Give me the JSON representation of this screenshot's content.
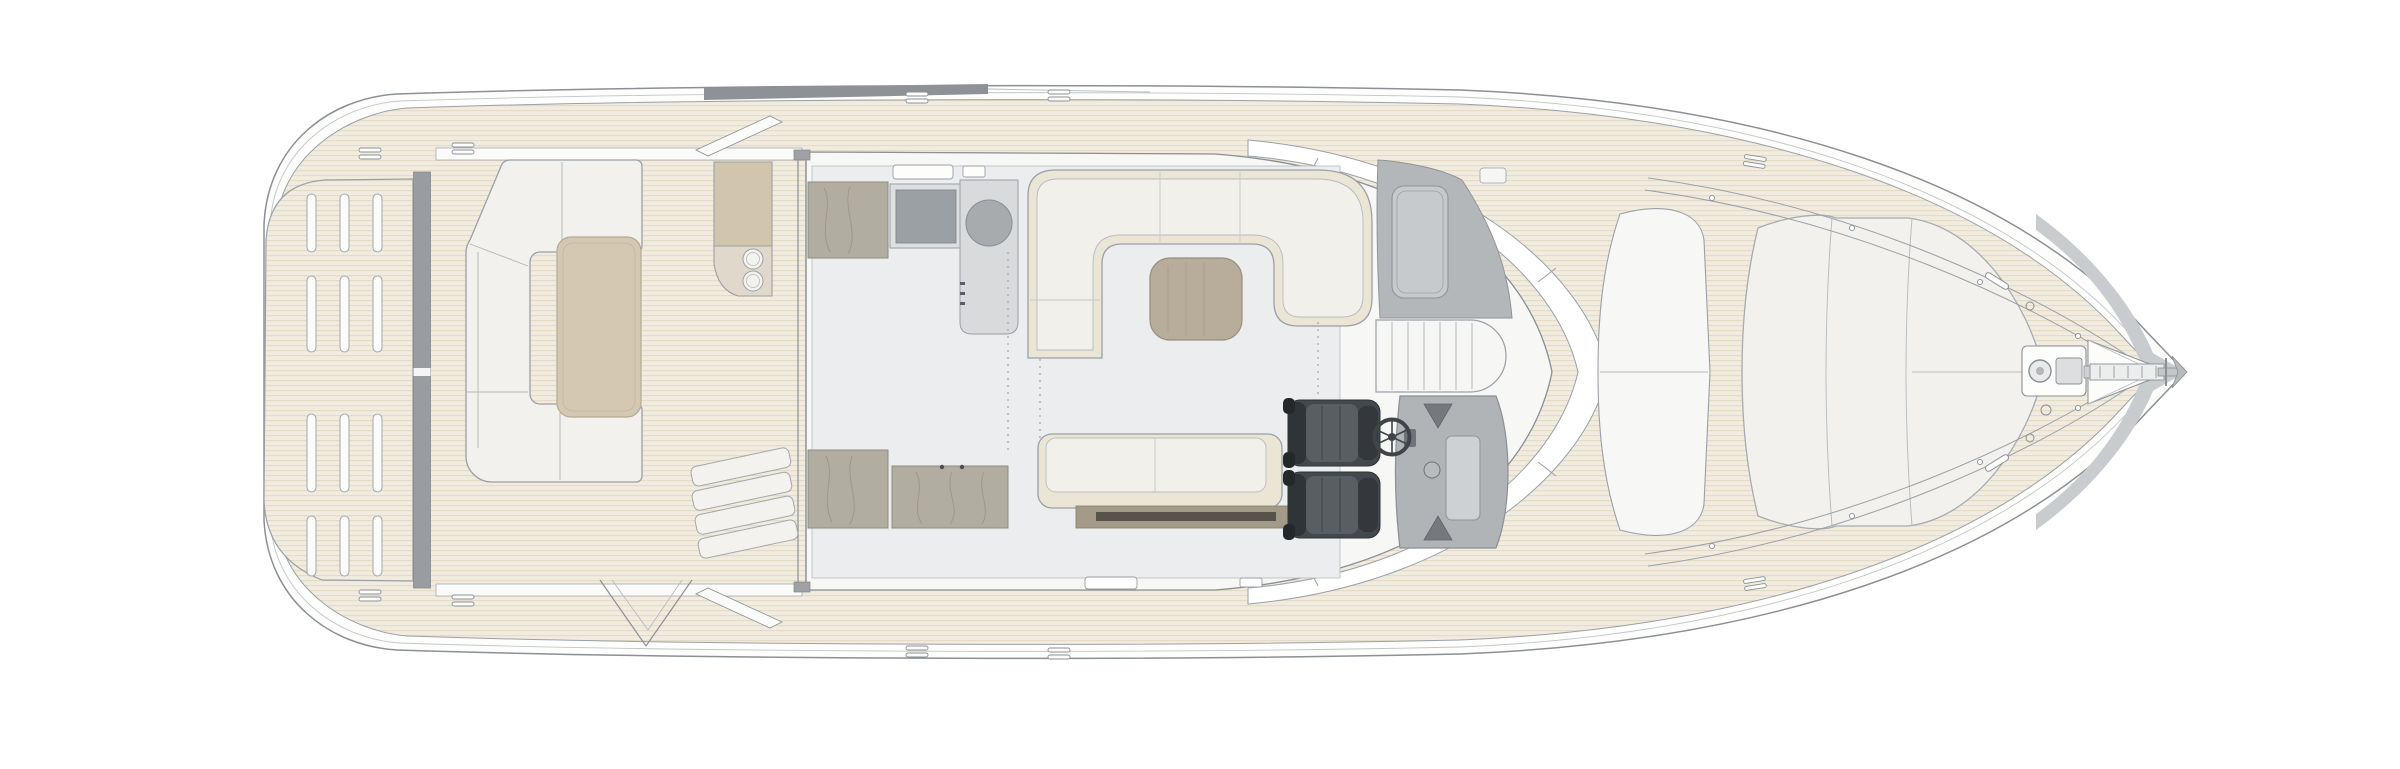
{
  "diagram": {
    "type": "yacht-deck-plan",
    "view": "top-down-floorplan",
    "background": "#ffffff"
  },
  "colors": {
    "line": "#8b9095",
    "line_light": "#b6bbc0",
    "teak": "#f1ecdf",
    "teak_stripe": "#e3dbc6",
    "hull": "#fdfdfc",
    "transom_strip": "#999da1",
    "hardtop_edge": "#8e9296",
    "interior": "#f7f7f6",
    "salon_floor": "#ebedef",
    "upholstery_cream": "#ebe5d5",
    "cushion_white": "#f2f0ea",
    "cockpit_table": "#d4c8b2",
    "salon_table_wood": "#b7ad9a",
    "cabinet_wood": "#b2ada1",
    "cabinet_wood_line": "#9d988c",
    "counter": "#d8dadc",
    "cooktop": "#9ba0a4",
    "sink": "#a7abae",
    "dashboard": "#b4b7ba",
    "console": "#b1b4b7",
    "seat_dark": "#43484c",
    "seat_cushion": "#595e62",
    "seat_trim": "#2f3437",
    "sunpad": "#f2f1ed",
    "bow_flare": "#c9ccce",
    "bench_plinth": "#a39a87",
    "bench_plinth_stripe": "#57534a",
    "wetbar_top": "#d2c5ae",
    "wetbar_body": "#e0d8ca"
  },
  "areas": {
    "hull": {
      "label": "Hull outline"
    },
    "swim_platform": {
      "label": "Swim platform with teak grating",
      "slot_rows": 4,
      "slot_columns": 3
    },
    "transom": {
      "label": "Transom"
    },
    "cockpit": {
      "label": "Cockpit"
    },
    "cockpit_sofa": {
      "label": "Cockpit C-shaped sofa"
    },
    "cockpit_table": {
      "label": "Cockpit table"
    },
    "wet_bar": {
      "label": "Wet bar with twin sinks"
    },
    "cockpit_steps": {
      "label": "Cockpit steps"
    },
    "salon": {
      "label": "Salon"
    },
    "galley": {
      "label": "Galley with cooktop and sink"
    },
    "salon_sofa": {
      "label": "Salon U-shaped sofa"
    },
    "salon_table": {
      "label": "Salon table"
    },
    "salon_bench": {
      "label": "Salon bench sofa"
    },
    "sideboard": {
      "label": "Sideboard cabinet"
    },
    "helm": {
      "label": "Helm station",
      "seat_count": 2
    },
    "helm_seats": {
      "label": "Helm seats"
    },
    "steering_wheel": {
      "label": "Steering wheel"
    },
    "helm_console": {
      "label": "Helm console"
    },
    "dashboard": {
      "label": "Dashboard coaming"
    },
    "companionway": {
      "label": "Companionway stairs"
    },
    "windshield": {
      "label": "Wraparound windshield"
    },
    "coachroof_window": {
      "label": "Windscreen glass panel"
    },
    "foredeck": {
      "label": "Foredeck"
    },
    "sunpad": {
      "label": "Foredeck sun pad"
    },
    "windlass": {
      "label": "Anchor windlass"
    },
    "anchor": {
      "label": "Anchor and chain track"
    },
    "bow": {
      "label": "Bow"
    },
    "side_decks": {
      "label": "Teak side decks"
    }
  }
}
